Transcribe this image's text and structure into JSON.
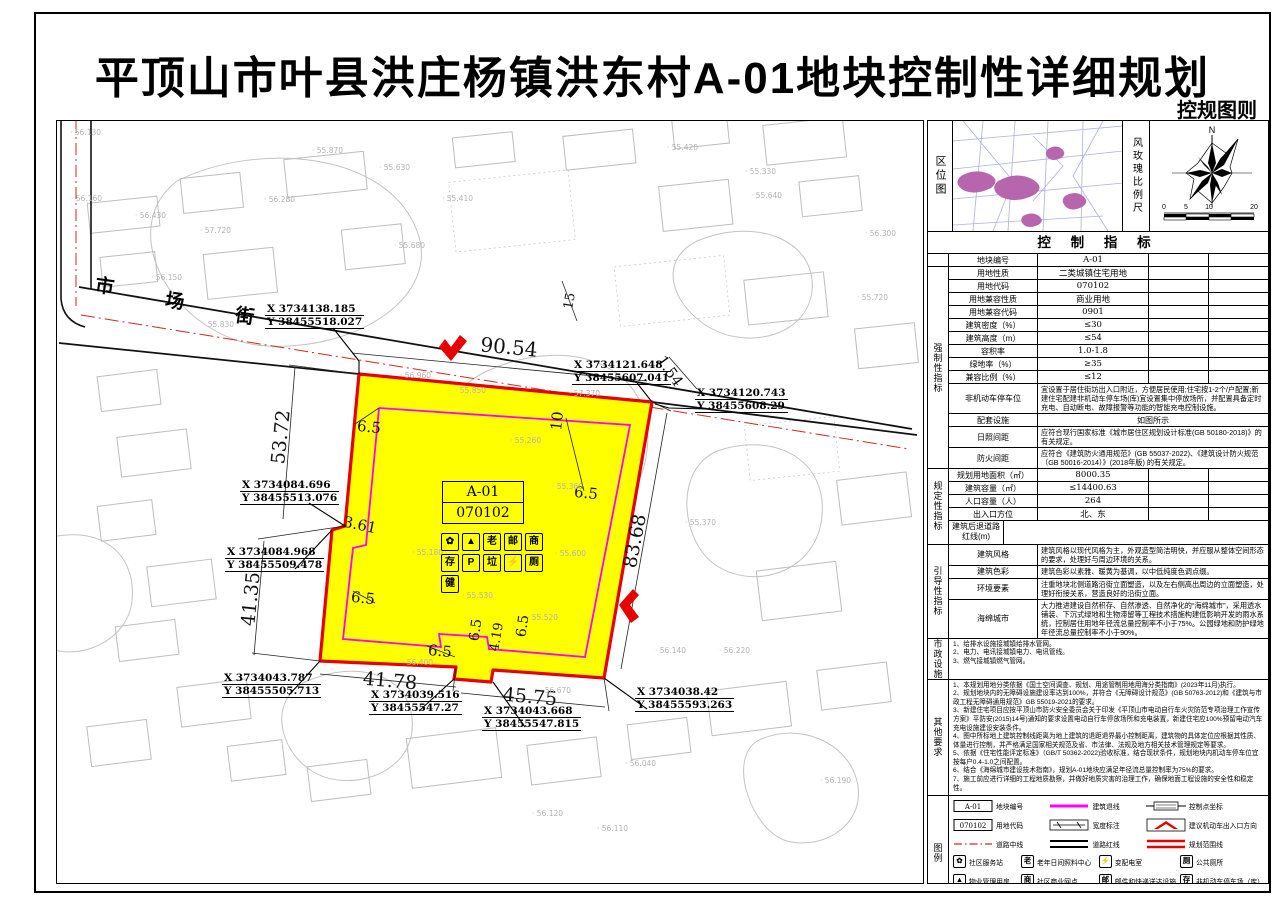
{
  "title": "平顶山市叶县洪庄杨镇洪东村A-01地块控制性详细规划",
  "subtitle": "控规图则",
  "colors": {
    "plot_fill": "#ffff00",
    "boundary_red": "#e60000",
    "setback_magenta": "#ff00ff",
    "centerline_red": "#cc2a2a"
  },
  "map": {
    "street_name": [
      "市",
      "场",
      "街"
    ],
    "plot_label": {
      "code": "A-01",
      "land_code": "070102"
    },
    "facility_icon_rows": [
      [
        {
          "name": "community-service-station-icon",
          "glyph": "✿"
        },
        {
          "name": "property-management-icon",
          "glyph": "▲"
        },
        {
          "name": "elderly-daycare-icon",
          "glyph": "老"
        },
        {
          "name": "mail-delivery-icon",
          "glyph": "邮"
        },
        {
          "name": "community-business-icon",
          "glyph": "商"
        }
      ],
      [
        {
          "name": "bicycle-parking-icon",
          "glyph": "存"
        },
        {
          "name": "car-parking-icon",
          "glyph": "P"
        },
        {
          "name": "garbage-collection-icon",
          "glyph": "垃"
        },
        {
          "name": "power-substation-icon",
          "glyph": "⚡"
        },
        {
          "name": "public-toilet-icon",
          "glyph": "厕"
        }
      ],
      [
        {
          "name": "outdoor-fitness-icon",
          "glyph": "健"
        }
      ]
    ],
    "dimensions": [
      {
        "label": "90.54",
        "x": 452,
        "y": 226,
        "rot": 5.5,
        "size": 20
      },
      {
        "label": "53.72",
        "x": 224,
        "y": 316,
        "rot": -84,
        "size": 19
      },
      {
        "label": "3.61",
        "x": 303,
        "y": 404,
        "rot": 12,
        "size": 15
      },
      {
        "label": "41.35",
        "x": 194,
        "y": 478,
        "rot": -84,
        "size": 19
      },
      {
        "label": "41.78",
        "x": 333,
        "y": 560,
        "rot": 5,
        "size": 19
      },
      {
        "label": "45.75",
        "x": 473,
        "y": 576,
        "rot": 5,
        "size": 19
      },
      {
        "label": "83.68",
        "x": 578,
        "y": 420,
        "rot": -79,
        "size": 19
      },
      {
        "label": "1.54",
        "x": 613,
        "y": 250,
        "rot": 55,
        "size": 15
      },
      {
        "label": "10",
        "x": 500,
        "y": 300,
        "rot": -84,
        "size": 15
      },
      {
        "label": "15",
        "x": 513,
        "y": 180,
        "rot": -80,
        "size": 13
      },
      {
        "label": "6.5",
        "x": 312,
        "y": 306,
        "rot": 6,
        "size": 15
      },
      {
        "label": "6.5",
        "x": 529,
        "y": 372,
        "rot": 6,
        "size": 15
      },
      {
        "label": "6.5",
        "x": 306,
        "y": 477,
        "rot": 6,
        "size": 15
      },
      {
        "label": "6.5",
        "x": 383,
        "y": 530,
        "rot": 5,
        "size": 15
      },
      {
        "label": "6.5",
        "x": 419,
        "y": 509,
        "rot": -82,
        "size": 14
      },
      {
        "label": "6.5",
        "x": 466,
        "y": 505,
        "rot": -82,
        "size": 14
      },
      {
        "label": "4.19",
        "x": 440,
        "y": 516,
        "rot": -80,
        "size": 13
      }
    ],
    "coordinates": [
      {
        "x_val": "X 3734138.185",
        "y_val": "Y 38455518.027",
        "lx": 208,
        "ly": 182
      },
      {
        "x_val": "X 3734121.648",
        "y_val": "Y 38455607.041",
        "lx": 515,
        "ly": 238
      },
      {
        "x_val": "X 3734120.743",
        "y_val": "Y 38455608.29",
        "lx": 638,
        "ly": 266
      },
      {
        "x_val": "X 3734084.696",
        "y_val": "Y 38455513.076",
        "lx": 183,
        "ly": 358
      },
      {
        "x_val": "X 3734084.968",
        "y_val": "Y 38455509.478",
        "lx": 168,
        "ly": 425
      },
      {
        "x_val": "X 3734043.787",
        "y_val": "Y 38455505.713",
        "lx": 165,
        "ly": 551
      },
      {
        "x_val": "X 3734039.516",
        "y_val": "Y 38455547.27",
        "lx": 312,
        "ly": 568
      },
      {
        "x_val": "X 3734043.668",
        "y_val": "Y 38455547.815",
        "lx": 425,
        "ly": 584
      },
      {
        "x_val": "X 3734038.42",
        "y_val": "Y 38455593.263",
        "lx": 578,
        "ly": 565
      }
    ],
    "spot_elevations": [
      {
        "v": "56.130",
        "x": 13,
        "y": 7
      },
      {
        "v": "56.160",
        "x": 14,
        "y": 73
      },
      {
        "v": "56.430",
        "x": 78,
        "y": 90
      },
      {
        "v": "57.720",
        "x": 143,
        "y": 105
      },
      {
        "v": "56.280",
        "x": 207,
        "y": 74
      },
      {
        "v": "55.870",
        "x": 255,
        "y": 25
      },
      {
        "v": "55.630",
        "x": 322,
        "y": 42
      },
      {
        "v": "55.410",
        "x": 385,
        "y": 73
      },
      {
        "v": "55.680",
        "x": 337,
        "y": 120
      },
      {
        "v": "56.150",
        "x": 94,
        "y": 152
      },
      {
        "v": "55.830",
        "x": 146,
        "y": 199
      },
      {
        "v": "56.960",
        "x": 343,
        "y": 250
      },
      {
        "v": "55.420",
        "x": 610,
        "y": 22
      },
      {
        "v": "55.330",
        "x": 688,
        "y": 46
      },
      {
        "v": "55.640",
        "x": 694,
        "y": 70
      },
      {
        "v": "56.300",
        "x": 808,
        "y": 108
      },
      {
        "v": "55.720",
        "x": 800,
        "y": 172
      },
      {
        "v": "57.370",
        "x": 512,
        "y": 268
      },
      {
        "v": "55.850",
        "x": 398,
        "y": 265
      },
      {
        "v": "55.260",
        "x": 453,
        "y": 315
      },
      {
        "v": "55.360",
        "x": 495,
        "y": 361
      },
      {
        "v": "55.600",
        "x": 498,
        "y": 428
      },
      {
        "v": "55.530",
        "x": 405,
        "y": 470
      },
      {
        "v": "55.180",
        "x": 355,
        "y": 427
      },
      {
        "v": "56.400",
        "x": 345,
        "y": 537
      },
      {
        "v": "55.520",
        "x": 470,
        "y": 492
      },
      {
        "v": "56.670",
        "x": 483,
        "y": 565
      },
      {
        "v": "56.140",
        "x": 598,
        "y": 525
      },
      {
        "v": "56.220",
        "x": 662,
        "y": 525
      },
      {
        "v": "55.370",
        "x": 628,
        "y": 397
      },
      {
        "v": "56.040",
        "x": 568,
        "y": 638
      },
      {
        "v": "56.120",
        "x": 475,
        "y": 688
      },
      {
        "v": "56.110",
        "x": 540,
        "y": 703
      },
      {
        "v": "56.190",
        "x": 763,
        "y": 655
      }
    ]
  },
  "panel": {
    "location_map_label": "区位图",
    "windrose_label": "风玫瑰比例尺",
    "north_label": "N",
    "scale_ticks": [
      "0",
      "5",
      "10",
      "20"
    ],
    "table_header": "控 制 指 标",
    "sections": [
      {
        "group": "",
        "rows": [
          {
            "t": "std",
            "l": "地块编号",
            "v": "A-01"
          }
        ]
      },
      {
        "group": "强制性指标",
        "rows": [
          {
            "t": "std",
            "l": "用地性质",
            "v": "二类城镇住宅用地"
          },
          {
            "t": "std",
            "l": "用地代码",
            "v": "070102"
          },
          {
            "t": "std",
            "l": "用地兼容性质",
            "v": "商业用地"
          },
          {
            "t": "std",
            "l": "用地兼容代码",
            "v": "0901"
          },
          {
            "t": "std",
            "l": "建筑密度（%）",
            "v": "≤30"
          },
          {
            "t": "std",
            "l": "建筑高度（m）",
            "v": "≤54"
          },
          {
            "t": "std",
            "l": "容积率",
            "v": "1.0-1.8"
          },
          {
            "t": "std",
            "l": "绿地率（%）",
            "v": "≥35"
          },
          {
            "t": "std",
            "l": "兼容比例（%）",
            "v": "≤12"
          },
          {
            "t": "span",
            "l": "非机动车停车位",
            "v": "宜设置于居住街坊出入口附近，方便居民使用;住宅按1-2个/户配置;新建住宅配建非机动车停车场(库)宜设置集中停放场所，并配置具备定时充电、自动断电、故障报警等功能的智能充电控制设施。"
          },
          {
            "t": "spanc",
            "l": "配套设施",
            "v": "如图所示"
          },
          {
            "t": "span",
            "l": "日照间距",
            "v": "应符合现行国家标准《城市居住区规划设计标准(GB 50180-2018)》的有关规定。"
          },
          {
            "t": "span",
            "l": "防火间距",
            "v": "应符合《建筑防火通用规范》(GB 55037-2022)、《建筑设计防火规范（GB 50016-2014）》(2018年版) 的有关规定。"
          }
        ]
      },
      {
        "group": "规定性指标",
        "rows": [
          {
            "t": "std",
            "l": "规划用地面积（㎡）",
            "v": "8000.35"
          },
          {
            "t": "std",
            "l": "建筑容量（㎡）",
            "v": "≤14400.63"
          },
          {
            "t": "std",
            "l": "人口容量（人）",
            "v": "264"
          },
          {
            "t": "std",
            "l": "出入口方位",
            "v": "北、东"
          },
          {
            "t": "setback"
          }
        ]
      },
      {
        "group": "引导性指标",
        "rows": [
          {
            "t": "span",
            "l": "建筑风格",
            "v": "建筑风格以现代风格为主，外观造型简洁明快，并应服从整体空间形态的要求，处理好与周边环境的关系。"
          },
          {
            "t": "span",
            "l": "建筑色彩",
            "v": "建筑色彩以素雅、暖黄为基调，以中低纯度色调点缀。"
          },
          {
            "t": "span",
            "l": "环境要素",
            "v": "注重地块北侧道路沿街立面塑造，以及左右侧高出周边的立面塑造，处理好衔接关系，营造良好的沿街立面。"
          },
          {
            "t": "span",
            "l": "海绵城市",
            "v": "大力推进建设自然积存、自然渗透、自然净化的“海绵城市”，采用透水铺装、下沉式绿地和生物滞留等工程技术措施构建低影响开发的雨水系统，控制居住用地年径流总量控制率不小于75%。公园绿地和防护绿地年径流总量控制率不小于90%。"
          }
        ]
      }
    ],
    "setback": {
      "label": "建筑后退道路红线(m)",
      "corner_top": "建筑高度",
      "corner_bottom": "方位名称",
      "col_header": "H≤54m",
      "rows": [
        [
          "E",
          "6.5"
        ],
        [
          "S",
          "6.5"
        ],
        [
          "W",
          "6.5"
        ],
        [
          "N",
          "10"
        ]
      ]
    },
    "municipal": {
      "group": "市政设施",
      "lines": [
        "1、给排水设施接城镇给排水管网。",
        "2、电力、电讯接城镇电力、电讯管线。",
        "3、燃气接城镇燃气管网。"
      ]
    },
    "other": {
      "group": "其他要求",
      "lines": [
        "1、本规划用地分类依据《国土空间调查、规划、用途管制用地用海分类指南》(2023年11月)执行。",
        "2、规划地块内的无障碍设施建设率达到100%，并符合《无障碍设计规范》(GB 50763-2012)和《建筑与市政工程无障碍通用规范》GB 55019-2021的要求。",
        "3、新建住宅项目应按平顶山市防火安全委员会关于印发《平顶山市电动自行车火灾防范专项治理工作宣传方案》平防安(2015)14号)通知的要求设置电动自行车停放场所和充电装置，新建住宅应100%预留电动汽车充电设施建设安装条件。",
        "4、图中所标地上建筑控制线距离为地上建筑的退距退界最小控制距离，建筑物的具体定位应根据其性质、体量进行控制，并严格满足国家相关规范及省、市法律、法规及地方相关技术管理规定等要求。",
        "5、依据《住宅性能评定标准》（GB/T 50362-2022)验收标准，结合现状条件，规划地块内机动车停车位宜按每户0.4-1.0之间配置。",
        "6、结合《海绵城市建设技术指南》，规划A-01地块应满足年径流总量控制率为75%的要求。",
        "7、施工前应进行详细的工程地质勘察，并做好地质灾害的治理工作，确保地面工程设施的安全性和稳定性。"
      ]
    }
  },
  "legend": {
    "group": "图例",
    "line_items": [
      {
        "sym": "a01box",
        "label": "地块编号",
        "text": "A-01"
      },
      {
        "sym": "magenta",
        "label": "建筑退线"
      },
      {
        "sym": "coord",
        "label": "控制点坐标"
      },
      {
        "sym": "codebox",
        "label": "用地代码",
        "text": "070102"
      },
      {
        "sym": "width",
        "label": "宽度标注"
      },
      {
        "sym": "arrow",
        "label": "建议机动车出入口方向"
      },
      {
        "sym": "center",
        "label": "道路中线"
      },
      {
        "sym": "redline",
        "label": "道路红线"
      },
      {
        "sym": "boundary",
        "label": "规划范围线"
      }
    ],
    "icon_items": [
      {
        "glyph": "✿",
        "label": "社区服务站",
        "name": "community-service-station-icon"
      },
      {
        "glyph": "老",
        "label": "老年日间照料中心",
        "name": "elderly-daycare-icon"
      },
      {
        "glyph": "⚡",
        "label": "变配电室",
        "name": "power-substation-icon"
      },
      {
        "glyph": "厕",
        "label": "公共厕所",
        "name": "public-toilet-icon"
      },
      {
        "glyph": "▲",
        "label": "物业管理用房",
        "name": "property-management-icon"
      },
      {
        "glyph": "商",
        "label": "社区商业网点",
        "name": "community-business-icon"
      },
      {
        "glyph": "邮",
        "label": "邮件和快递送达设施",
        "name": "mail-delivery-icon"
      },
      {
        "glyph": "存",
        "label": "非机动车停车场（库）",
        "name": "bicycle-parking-icon"
      },
      {
        "glyph": "健",
        "label": "室外健身器材",
        "name": "outdoor-fitness-icon"
      },
      {
        "glyph": "垃",
        "label": "生活垃圾收集站",
        "name": "garbage-collection-icon"
      },
      {
        "glyph": "P",
        "label": "机动车停车场（库）",
        "name": "car-parking-icon"
      }
    ]
  }
}
